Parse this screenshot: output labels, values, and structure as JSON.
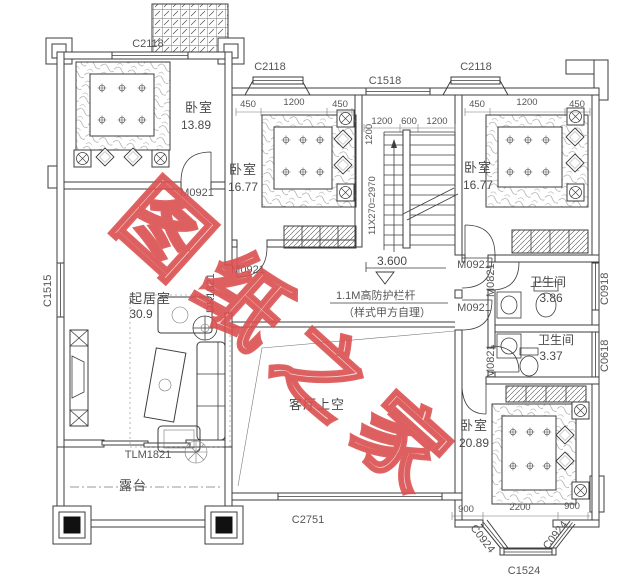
{
  "watermark": {
    "text": "图纸之家",
    "color": "#e05c5c"
  },
  "rooms": {
    "bedroom_tl": {
      "name": "卧室",
      "area": "13.89"
    },
    "bedroom_mid": {
      "name": "卧室",
      "area": "16.77"
    },
    "bedroom_tr": {
      "name": "卧室",
      "area": "16.77"
    },
    "living": {
      "name": "起居室",
      "area": "30.9"
    },
    "bath_top": {
      "name": "卫生间",
      "area": "3.86"
    },
    "bath_bottom": {
      "name": "卫生间",
      "area": "3.37"
    },
    "bedroom_br": {
      "name": "卧室",
      "area": "20.89"
    },
    "terrace": {
      "name": "露台"
    },
    "void": {
      "name": "客厅上空"
    }
  },
  "windows": {
    "c2118_left": "C2118",
    "c2118_mid": "C2118",
    "c1518": "C1518",
    "c2118_right": "C2118",
    "c1515": "C1515",
    "c0918": "C0918",
    "c0618": "C0618",
    "c2751": "C2751",
    "c0924_left": "C0924",
    "c0924_right": "C0924",
    "c1524": "C1524"
  },
  "doors": {
    "m0921_tl": "M0921",
    "m0921_mid": "M0921",
    "m0921_hall_top": "M0921",
    "m0921_hall_bottom": "M0921",
    "m0821_top": "M0821",
    "m0821_bottom": "M0821",
    "dk1821": "DK1821",
    "tlm1821": "TLM1821"
  },
  "dimensions": {
    "mid_bedroom": [
      "450",
      "1200",
      "450"
    ],
    "right_bedroom": [
      "450",
      "1200",
      "450"
    ],
    "stair_width": [
      "1200",
      "600",
      "1200"
    ],
    "stair_depth": "1200",
    "stair_run": "11X270=2970",
    "bay": [
      "900",
      "2200",
      "900"
    ]
  },
  "annotations": {
    "level": "3.600",
    "railing_line1": "1.1M高防护栏杆",
    "railing_line2": "（样式甲方自理）"
  }
}
